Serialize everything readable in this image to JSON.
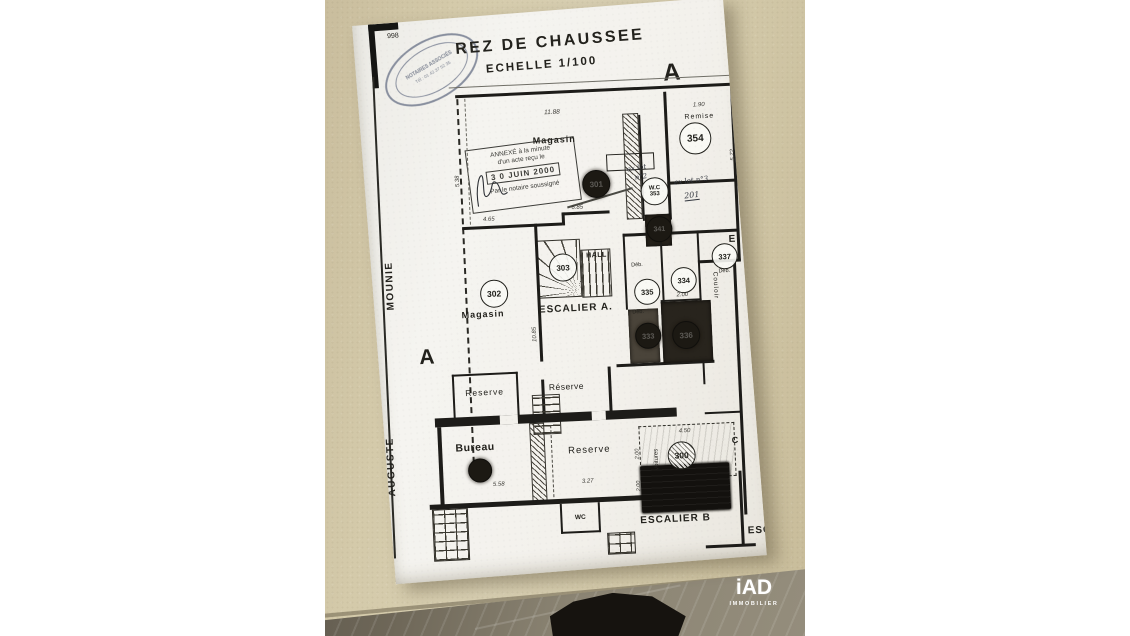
{
  "brand": {
    "logo_text": "iAD",
    "logo_sub": "IMMOBILIER",
    "logo_color": "#ffffff"
  },
  "photo": {
    "surface_color": "#d2c8a8",
    "floor_color": "#8b8473",
    "background": "#ffffff"
  },
  "document": {
    "page_number": "998",
    "notary_oval": {
      "line1": "NOTAIRES ASSOCIÉS",
      "line2": "Tél : 01 42 37 52 35"
    },
    "title": "REZ DE CHAUSSEE",
    "scale": "ECHELLE 1/100",
    "letters": {
      "a_top": "A",
      "a_left": "A",
      "e_right": "E",
      "c_right": "C"
    },
    "street": {
      "word_top": "MOUNIE",
      "word_bottom": "AUGUSTE"
    },
    "annex_stamp": {
      "line1": "ANNEXÉ à la minute",
      "line2": "d'un acte reçu le",
      "date": "3 0 JUIN 2000",
      "line3": "Par le notaire soussigné"
    },
    "handwritten": {
      "lot2_a": "ex lot",
      "lot2_b": "n°2",
      "lot3": "ex lot n°3",
      "lot3_num": "201"
    },
    "labels": {
      "magasin_top": "Magasin",
      "remise": "Remise",
      "wc_353": "W.C",
      "hall": "HALL",
      "escalier_a": "ESCALIER A.",
      "magasin_302": "Magasin",
      "reserve_left": "Reserve",
      "reserve_mid": "Réserve",
      "reserve_right": "Reserve",
      "bureau": "Bureau",
      "couloir": "Couloir",
      "voitures": "Voitures",
      "escalier_b": "ESCALIER B",
      "escal": "ESCAL",
      "wc_bottom": "WC",
      "deb": "Déb."
    },
    "numbers": {
      "n354": "354",
      "n353": "353",
      "n341": "341",
      "n301": "301",
      "n303": "303",
      "n335": "335",
      "n334": "334",
      "n337": "337",
      "n333": "333",
      "n336": "336",
      "n302": "302",
      "n300": "300"
    },
    "dims": {
      "d1188": "11.88",
      "d190": "1.90",
      "d572": "5.72",
      "d538": "5.38",
      "d465": "4.65",
      "d685": "6.85",
      "d1085": "10.85",
      "d200_334": "2.00",
      "d200_g1": "2.00",
      "d200_g2": "2.00",
      "d450": "4.50",
      "d558": "5.58",
      "d327": "3.27"
    }
  }
}
